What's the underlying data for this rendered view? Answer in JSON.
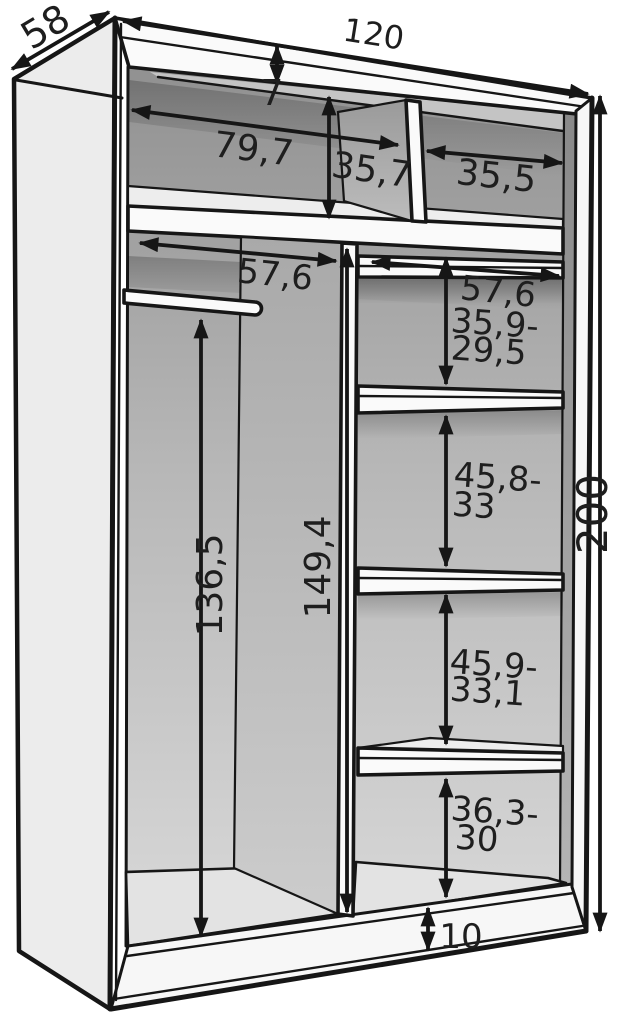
{
  "diagram": {
    "kind": "wardrobe-interior-dimension-drawing",
    "dimensions": {
      "overall": {
        "width": "120",
        "depth": "58",
        "height": "200"
      },
      "top": {
        "panel_thickness": "7",
        "left_compartment_width": "79,7",
        "compartment_height": "35,7",
        "right_compartment_width": "35,5"
      },
      "depth_inner": {
        "left": "57,6",
        "right": "57,6"
      },
      "right_column_gaps": [
        {
          "line1": "35,9-",
          "line2": "29,5"
        },
        {
          "line1": "45,8-",
          "line2": "33"
        },
        {
          "line1": "45,9-",
          "line2": "33,1"
        },
        {
          "line1": "36,3-",
          "line2": "30"
        }
      ],
      "left_section": {
        "rod_height": "136,5",
        "partition_height": "149,4"
      },
      "base": {
        "plinth_height": "10"
      }
    }
  }
}
